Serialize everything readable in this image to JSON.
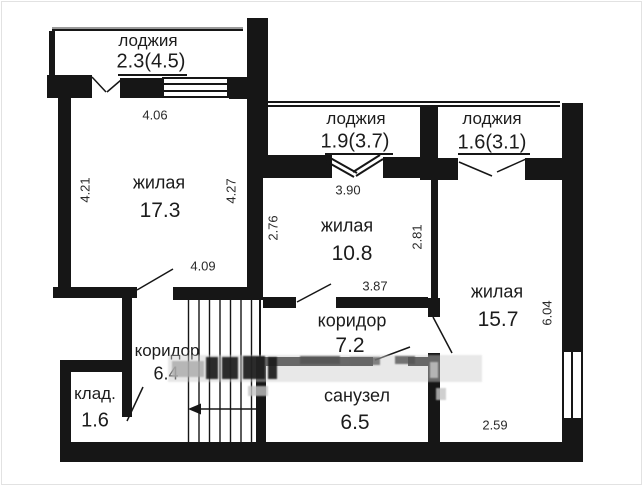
{
  "plan": {
    "type": "apartment-floor-plan",
    "rooms": [
      {
        "name": "лоджия",
        "area": "2.3(4.5)"
      },
      {
        "name": "лоджия",
        "area": "1.9(3.7)"
      },
      {
        "name": "лоджия",
        "area": "1.6(3.1)"
      },
      {
        "name": "жилая",
        "area": "17.3"
      },
      {
        "name": "жилая",
        "area": "10.8"
      },
      {
        "name": "жилая",
        "area": "15.7"
      },
      {
        "name": "коридор",
        "area": "7.2"
      },
      {
        "name": "санузел",
        "area": "6.5"
      },
      {
        "name": "коридор",
        "area": "6.4"
      },
      {
        "name": "клад.",
        "area": "1.6"
      }
    ],
    "dimensions": {
      "d406": "4.06",
      "d421": "4.21",
      "d427": "4.27",
      "d409": "4.09",
      "d390": "3.90",
      "d276": "2.76",
      "d281": "2.81",
      "d387": "3.87",
      "d604": "6.04",
      "d259": "2.59"
    },
    "colors": {
      "wall": "#161616",
      "text": "#1c1c1c",
      "railing": "#9a9a9a",
      "background": "#ffffff"
    }
  }
}
